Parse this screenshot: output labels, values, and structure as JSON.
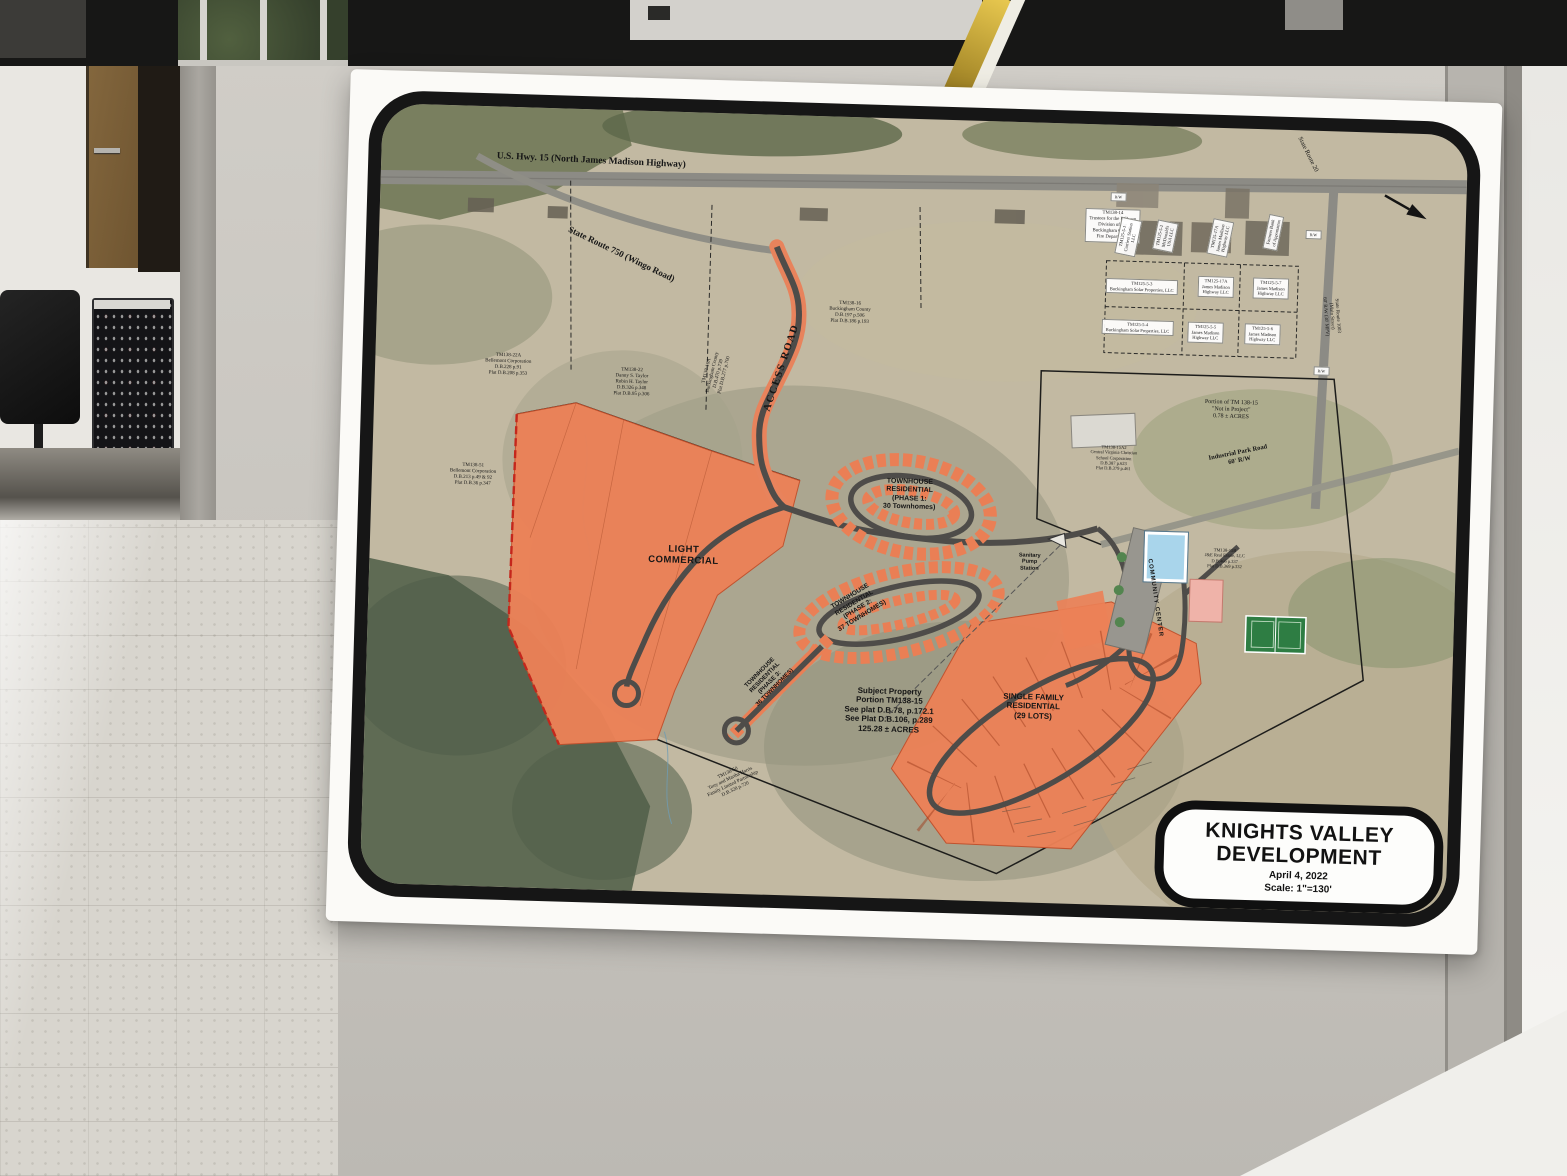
{
  "map": {
    "title_block": {
      "line1": "KNIGHTS VALLEY",
      "line2": "DEVELOPMENT",
      "date": "April 4, 2022",
      "scale": "Scale: 1\"=130'"
    },
    "accent_colors": {
      "parcel_orange": "#ec8157",
      "boundary_red": "#c4271c",
      "road_gray": "#4e4c49",
      "pool_blue": "#a9d5eb",
      "court_green": "#2e7d43"
    },
    "labels": [
      {
        "id": "us-hwy-15",
        "text": "U.S. Hwy. 15 (North James Madison Highway)",
        "x": 210,
        "y": 52,
        "fs": 9.5,
        "rot": 1,
        "serif": true,
        "bold": true
      },
      {
        "id": "state-route-750",
        "text": "State Route 750 (Wingo Road)",
        "x": 243,
        "y": 144,
        "fs": 9,
        "rot": 24,
        "serif": true,
        "bold": true
      },
      {
        "id": "access-road",
        "text": "ACCESS ROAD",
        "x": 407,
        "y": 253,
        "fs": 10.5,
        "rot": -73,
        "serif": true,
        "bold": true,
        "ls": 1.5
      },
      {
        "id": "tm138-16",
        "text": "TM138-16\nBuckingham County\nD.B.197 p.506\nPlat D.B.186 p.193",
        "x": 473,
        "y": 196,
        "fs": 5,
        "serif": true
      },
      {
        "id": "tm138-16a",
        "text": "TM138-16A\nBuckingham County\nD.B.470 p.739\nPlat D.B.277 p.700",
        "x": 341,
        "y": 260,
        "fs": 5,
        "rot": -78,
        "serif": true
      },
      {
        "id": "tm138-22a",
        "text": "TM138-22A\nBellemont Corporation\nD.B.228 p.91\nPlat D.B.208 p.353",
        "x": 133,
        "y": 258,
        "fs": 5,
        "serif": true
      },
      {
        "id": "tm138-22",
        "text": "TM138-22\nDanny S. Taylor\nRobin H. Taylor\nD.B.326 p.348\nPlat D.B.95 p.306",
        "x": 257,
        "y": 272,
        "fs": 5,
        "serif": true
      },
      {
        "id": "tm138-51",
        "text": "TM138-51\nBellemont Corporation\nD.B.213 p.49 & 92\nPlat D.B.36 p.347",
        "x": 101,
        "y": 369,
        "fs": 5,
        "serif": true
      },
      {
        "id": "light-commercial",
        "text": "LIGHT\nCOMMERCIAL",
        "x": 314,
        "y": 443,
        "fs": 9.5,
        "bold": true,
        "ls": 0.5
      },
      {
        "id": "townhouse-phase-1",
        "text": "TOWNHOUSE\nRESIDENTIAL\n(PHASE 1:\n30 Townhomes)",
        "x": 538,
        "y": 376,
        "fs": 7,
        "bold": true
      },
      {
        "id": "townhouse-phase-2",
        "text": "TOWNHOUSE\nRESIDENTIAL\n(PHASE 2:\n37 TOWNHOMES)",
        "x": 488,
        "y": 489,
        "fs": 6.5,
        "rot": -33,
        "bold": true
      },
      {
        "id": "townhouse-phase-3",
        "text": "TOWNHOUSE\nRESIDENTIAL\n(PHASE 3:\n36 TOWNHOMES)",
        "x": 402,
        "y": 566,
        "fs": 6,
        "rot": -47,
        "bold": true
      },
      {
        "id": "subject-property",
        "text": "Subject Property\nPortion TM138-15\nSee plat D.B.78, p.172.1\nSee Plat D.B.106, p.289\n125.28 ± ACRES",
        "x": 524,
        "y": 592,
        "fs": 8,
        "bold": true
      },
      {
        "id": "single-family",
        "text": "SINGLE FAMILY\nRESIDENTIAL\n(29 LOTS)",
        "x": 668,
        "y": 584,
        "fs": 8,
        "bold": true
      },
      {
        "id": "sanitary-pump-station",
        "text": "Sanitary\nPump\nStation",
        "x": 660,
        "y": 440,
        "fs": 5.5,
        "bold": true
      },
      {
        "id": "community-center",
        "text": "COMMUNITY CENTER",
        "x": 786,
        "y": 472,
        "fs": 6,
        "rot": 80,
        "bold": true,
        "ls": 1
      },
      {
        "id": "fire-department",
        "text": "TM138-14\nTrustees for the Dillwyn\nDivision of the\nBuckingham County\nFire Department",
        "x": 733,
        "y": 101,
        "fs": 4.8,
        "serif": true,
        "bg": true
      },
      {
        "id": "tm125-5-1",
        "text": "TM125-5-1\nCurriers Station\nLLC",
        "x": 749,
        "y": 112,
        "fs": 4.5,
        "rot": -80,
        "serif": true,
        "bg": true
      },
      {
        "id": "tm125-5-2",
        "text": "TM125-5-2\nMcDonald's\nUSA LLC",
        "x": 786,
        "y": 110,
        "fs": 4.5,
        "rot": -80,
        "serif": true,
        "bg": true
      },
      {
        "id": "tm125-17a-north",
        "text": "TM125-17A\nJames Madison\nHighway LLC",
        "x": 841,
        "y": 110,
        "fs": 4.5,
        "rot": -80,
        "serif": true,
        "bg": true
      },
      {
        "id": "farmers-bank",
        "text": "Farmers Bank\nof Appomattox",
        "x": 894,
        "y": 103,
        "fs": 4.5,
        "rot": -80,
        "serif": true,
        "bg": true
      },
      {
        "id": "tm125-5-3",
        "text": "TM125-5-3\nBuckingham Solar Properties, LLC",
        "x": 764,
        "y": 161,
        "fs": 4.5,
        "serif": true,
        "bg": true
      },
      {
        "id": "tm125-17a",
        "text": "TM125-17A\nJames Madison\nHighway LLC",
        "x": 838,
        "y": 159,
        "fs": 4.5,
        "serif": true,
        "bg": true
      },
      {
        "id": "tm125-5-7",
        "text": "TM125-5-7\nJames Madison\nHighway LLC",
        "x": 893,
        "y": 159,
        "fs": 4.5,
        "serif": true,
        "bg": true
      },
      {
        "id": "tm125-5-4",
        "text": "TM125-5-4\nBuckingham Solar Properties, LLC",
        "x": 761,
        "y": 202,
        "fs": 4.5,
        "serif": true,
        "bg": true
      },
      {
        "id": "tm125-5-5",
        "text": "TM125-5-5\nJames Madison\nHighway LLC",
        "x": 829,
        "y": 205,
        "fs": 4.5,
        "serif": true,
        "bg": true
      },
      {
        "id": "tm125-5-6",
        "text": "TM125-5-6\nJames Madison\nHighway LLC",
        "x": 886,
        "y": 205,
        "fs": 4.5,
        "serif": true,
        "bg": true
      },
      {
        "id": "not-in-project",
        "text": "Portion of TM 138-15\n\"Not in Project\"\n0.78 ± ACRES",
        "x": 857,
        "y": 282,
        "fs": 6,
        "serif": true
      },
      {
        "id": "industrial-park-road",
        "text": "Industrial Park Road\n60'  R/W",
        "x": 866,
        "y": 328,
        "fs": 6.5,
        "rot": -13,
        "serif": true,
        "bold": true
      },
      {
        "id": "school",
        "text": "TM138-15A2\nCentral Virginia Christian\nSchool Corporation\nD.B.387 p.623\nPlat D.B.379 p.461",
        "x": 741,
        "y": 333,
        "fs": 4.5,
        "serif": true
      },
      {
        "id": "tm138-15b",
        "text": "TM138-15B\nJ&E Real Estate, LLC\nD.B.466 p.337\nPlat D.B.369 p.332",
        "x": 855,
        "y": 430,
        "fs": 4.5,
        "serif": true
      },
      {
        "id": "state-route-20",
        "text": "State Route 20",
        "x": 926,
        "y": 24,
        "fs": 6.5,
        "rot": 62,
        "serif": true
      },
      {
        "id": "state-route-1003",
        "text": "State Route 1003\n(Main Street)\n60' R/W (30' MPV)",
        "x": 954,
        "y": 185,
        "fs": 5,
        "rot": 84,
        "serif": true
      },
      {
        "id": "tm138-50",
        "text": "TM138-50\nTony and Martha Harris\nFamily Limited Partnership\nD.B.328 p.720",
        "x": 369,
        "y": 668,
        "fs": 5,
        "rot": -27,
        "serif": true
      },
      {
        "id": "rw-1",
        "text": "R/W",
        "x": 738,
        "y": 72,
        "fs": 4,
        "serif": true,
        "bg": true
      },
      {
        "id": "rw-2",
        "text": "R/W",
        "x": 934,
        "y": 104,
        "fs": 4,
        "serif": true,
        "bg": true
      },
      {
        "id": "rw-3",
        "text": "R/W",
        "x": 946,
        "y": 240,
        "fs": 4,
        "serif": true,
        "bg": true
      }
    ]
  }
}
